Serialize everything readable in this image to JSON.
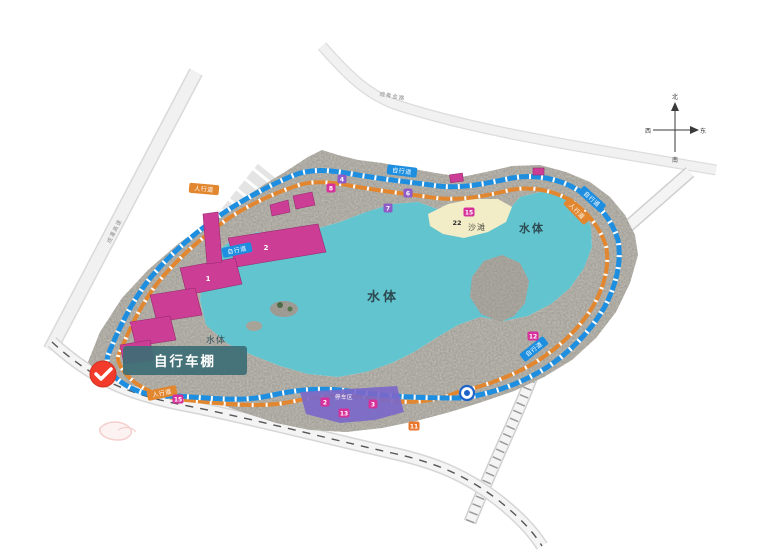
{
  "map": {
    "tooltip": {
      "text": "自行车棚"
    },
    "water_labels": {
      "main": "水体",
      "east": "水体",
      "west": "水体"
    },
    "beach_label": "沙滩",
    "zone_label": "停车区",
    "paths": {
      "bike": "自行道",
      "walk": "人行道"
    },
    "roads": {
      "northwest": "成灌高速",
      "north": "成青金路"
    },
    "buildings": {
      "b1": "1",
      "b2": "2"
    },
    "markers": [
      {
        "label": "4",
        "color": "violet"
      },
      {
        "label": "8",
        "color": "magenta"
      },
      {
        "label": "6",
        "color": "violet"
      },
      {
        "label": "7",
        "color": "violet"
      },
      {
        "label": "15",
        "color": "magenta"
      },
      {
        "label": "22",
        "color": "plain"
      },
      {
        "label": "12",
        "color": "magenta"
      },
      {
        "label": "15",
        "color": "magenta"
      },
      {
        "label": "2",
        "color": "magenta"
      },
      {
        "label": "3",
        "color": "magenta"
      },
      {
        "label": "13",
        "color": "magenta"
      },
      {
        "label": "11",
        "color": "orange"
      }
    ],
    "compass": {
      "north": "北",
      "south": "南",
      "east": "东",
      "west": "西"
    },
    "colors": {
      "water": "#62c4ce",
      "sand": "#f2ecc7",
      "building": "#cc3e96",
      "bike_path": "#1e8fe0",
      "walk_path": "#e2872f",
      "zone_purple": "#7b68c9",
      "marker_magenta": "#d6309a",
      "marker_violet": "#8e5bc8",
      "marker_orange": "#e8762c",
      "tooltip_bg": "#3d6e75",
      "pin": "#f23b2b"
    }
  }
}
